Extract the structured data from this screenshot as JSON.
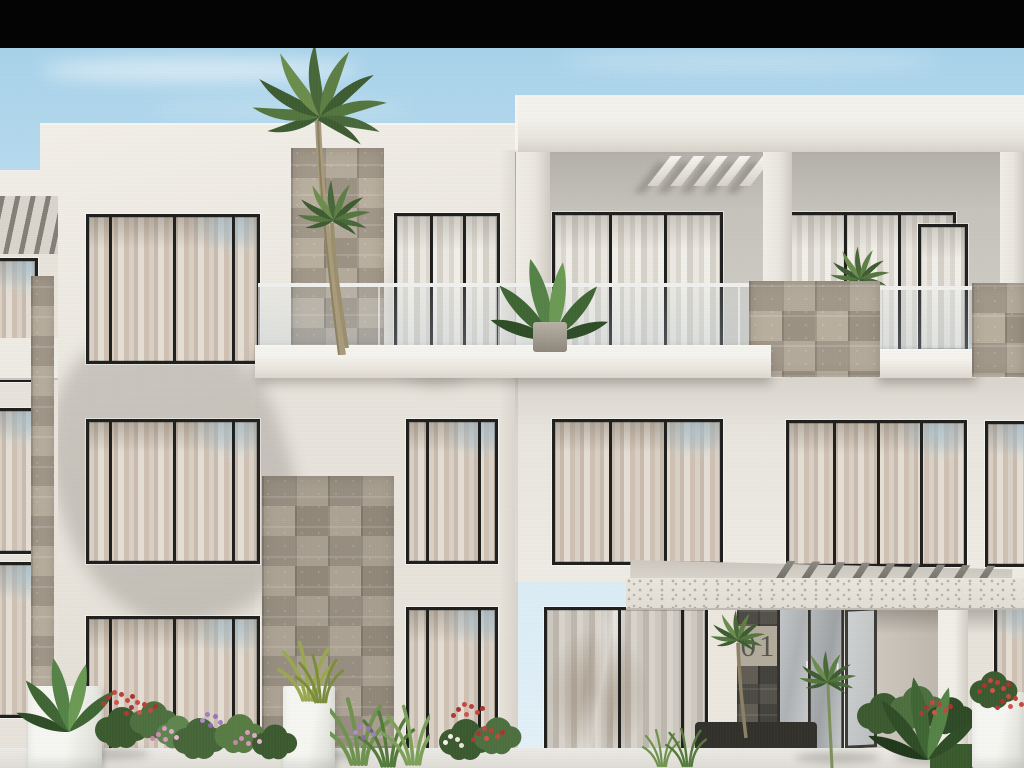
{
  "scene": {
    "type": "architectural-exterior-render",
    "description": "Modern three-storey white residential building with glass-balustrade balconies, beige stone-clad piers, sheer-curtained floor-to-ceiling windows, palm trees, flowering planters and a canopied entrance marked 01. A black letterbox bar crosses the top of the frame.",
    "sky": "clear light blue with thin white clouds"
  },
  "entrance": {
    "unit_number": "01"
  },
  "palette": {
    "letterbox": "#040404",
    "sky_top": "#a2cfe9",
    "sky_bottom": "#d3e9f5",
    "wall_bright": "#f0ede6",
    "wall_mid": "#e7e3db",
    "wall_shadow": "#d6d2ca",
    "recess_wall": "#c8c5be",
    "stone_a": "#b4aa9b",
    "stone_b": "#9c9283",
    "stone_dark": "#4b4943",
    "stone_band_light": "#b3ab9c",
    "frame_dark": "#1f1f1e",
    "door_frame": "#34322e",
    "glass_cool": "#ced3d5",
    "curtain_warm": "#cfc2b4",
    "curtain_light": "#eae7e1",
    "canopy_face": "#e7e3db",
    "pergola_bar": "#75726b",
    "foliage_dark": "#2f4a27",
    "foliage_mid": "#4a6c39",
    "foliage_light": "#6f934f",
    "trunk": "#a39878",
    "flower_red": "#b8413a",
    "flower_pink": "#db9dbf",
    "flower_purple": "#a57fc0",
    "planter_white": "#f1f1ed",
    "soil_dark": "#33312c",
    "pavement": "#e9e6e1",
    "unit_number_color": "#4f4e47"
  }
}
